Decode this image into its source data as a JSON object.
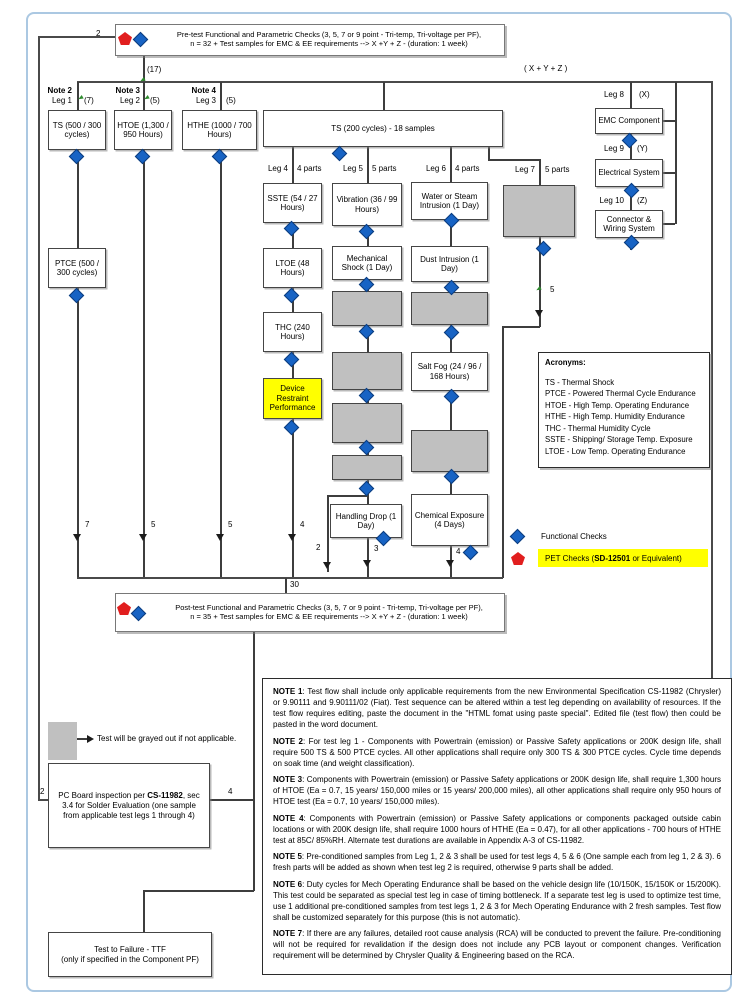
{
  "pretest": {
    "line1": "Pre-test Functional and Parametric Checks (3, 5, 7 or 9 point - Tri-temp, Tri-voltage per PF),",
    "line2": "n = 32 + Test samples for EMC & EE requirements --> X +Y + Z  - (duration: 1 week)"
  },
  "posttest": {
    "line1": "Post-test Functional and Parametric Checks (3, 5, 7 or 9 point - Tri-temp, Tri-voltage per PF),",
    "line2": "n = 35 + Test samples for EMC & EE requirements --> X +Y + Z  - (duration: 1 week)"
  },
  "labels": {
    "two": "2",
    "seventeen": "(17)",
    "xyz": "( X + Y + Z )",
    "thirty": "30",
    "leg1_count": "7",
    "leg2_count": "5",
    "leg3_count": "5",
    "leg4_count": "4",
    "leg5_branch": "2",
    "leg5_count": "3",
    "leg6_count": "4",
    "leg7_count": "5",
    "pc_left": "2",
    "pc_right": "4"
  },
  "top_legs": [
    {
      "note": "Note 2",
      "leg": "Leg 1",
      "count": "(7)",
      "box": "TS (500 / 300 cycles)"
    },
    {
      "note": "Note 3",
      "leg": "Leg 2",
      "count": "(5)",
      "box": "HTOE (1,300 / 950 Hours)"
    },
    {
      "note": "Note 4",
      "leg": "Leg 3",
      "count": "(5)",
      "box": "HTHE (1000 / 700 Hours)"
    }
  ],
  "mid_legs": [
    {
      "leg": "Leg 4",
      "parts": "4 parts"
    },
    {
      "leg": "Leg 5",
      "parts": "5 parts"
    },
    {
      "leg": "Leg 6",
      "parts": "4 parts"
    },
    {
      "leg": "Leg 7",
      "parts": "5 parts"
    }
  ],
  "right_legs": [
    {
      "leg": "Leg 8",
      "var": "(X)",
      "box": "EMC Component"
    },
    {
      "leg": "Leg 9",
      "var": "(Y)",
      "box": "Electrical System"
    },
    {
      "leg": "Leg 10",
      "var": "(Z)",
      "box": "Connector & Wiring System"
    }
  ],
  "boxes": {
    "ptce": "PTCE (500 / 300 cycles)",
    "ts200": "TS (200 cycles) - 18 samples",
    "sste": "SSTE (54 / 27 Hours)",
    "ltoe": "LTOE (48 Hours)",
    "thc": "THC (240 Hours)",
    "device": "Device Restraint Performance",
    "vibration": "Vibration (36 / 99 Hours)",
    "mshock": "Mechanical Shock (1 Day)",
    "hdrop": "Handling Drop (1 Day)",
    "water": "Water or Steam Intrusion (1 Day)",
    "dust": "Dust Intrusion (1 Day)",
    "saltfog": "Salt Fog (24 / 96 / 168 Hours)",
    "chem": "Chemical Exposure (4 Days)"
  },
  "acronyms": {
    "title": "Acronyms:",
    "items": [
      "TS - Thermal Shock",
      "PTCE - Powered Thermal Cycle Endurance",
      "HTOE - High Temp. Operating Endurance",
      "HTHE - High Temp. Humidity Endurance",
      "THC - Thermal Humidity Cycle",
      "SSTE - Shipping/ Storage Temp. Exposure",
      "LTOE - Low Temp. Operating Endurance"
    ]
  },
  "legend": {
    "functional": "Functional Checks",
    "pet_prefix": "PET Checks (",
    "pet_bold": "SD-12501",
    "pet_suffix": " or Equivalent)"
  },
  "gray_note": "Test will be grayed out if not applicable.",
  "pc_board": {
    "prefix": "PC Board inspection per ",
    "bold": "CS-11982",
    "suffix": ", sec 3.4 for Solder Evaluation (one sample from applicable test legs 1 through 4)"
  },
  "ttf": {
    "line1": "Test to Failure - TTF",
    "line2": "(only if specified in the Component PF)"
  },
  "colors": {
    "functional_check": "#1763c4",
    "pet_check": "#e11e1e",
    "grayed_test": "#c0c0c0",
    "highlight": "#ffff00",
    "page_border": "#abc8e2"
  },
  "notes": [
    {
      "label": "NOTE 1",
      "text": ": Test flow shall include only applicable requirements from the new Environmental Specification CS-11982 (Chrysler) or 9.90111 and 9.90111/02 (Fiat). Test sequence can be altered within a test leg depending on availability of resources.  If the test flow requires editing, paste the document in the \"HTML fomat using paste special\".  Edited file (test flow) then could be pasted in the word document."
    },
    {
      "label": "NOTE 2",
      "text": ": For test leg 1 - Components with Powertrain (emission) or Passive Safety applications or 200K design life, shall require 500 TS & 500 PTCE cycles. All other applications shall require only 300 TS & 300 PTCE cycles. Cycle time depends on soak time (and weight classification)."
    },
    {
      "label": "NOTE 3",
      "text": ": Components with Powertrain (emission) or Passive Safety applications or 200K design life, shall require 1,300 hours of HTOE (Ea = 0.7, 15 years/ 150,000 miles or 15 years/ 200,000 miles), all other applications shall require only 950 hours of HTOE test (Ea = 0.7, 10 years/ 150,000 miles)."
    },
    {
      "label": "NOTE 4",
      "text": ": Components with Powertrain (emission) or Passive Safety applications or components packaged outside cabin locations or with 200K design life, shall require 1000 hours of HTHE (Ea = 0.47), for all other applications - 700 hours of HTHE test at 85C/ 85%RH.  Alternate test durations are available in Appendix A-3 of CS-11982."
    },
    {
      "label": "NOTE 5",
      "text": ": Pre-conditioned samples from Leg 1, 2 & 3 shall be used for test legs 4, 5 & 6 (One sample each from leg 1, 2 & 3).  6 fresh parts will be added as shown when test leg 2 is required, otherwise 9 parts shall be added."
    },
    {
      "label": "NOTE 6",
      "text": ": Duty cycles for Mech Operating Endurance shall be based on the vehicle design life (10/150K, 15/150K or 15/200K).  This test could be separated as special test leg in case of timing bottleneck.  If a separate test leg is used to optimize test time, use 1 additional pre-conditioned samples from test legs 1, 2 & 3 for Mech Operating Endurance with 2 fresh samples.  Test flow shall be customized separately for this purpose (this is not automatic)."
    },
    {
      "label": "NOTE 7",
      "text": ": If there are any failures, detailed root cause analysis (RCA) will be conducted to prevent the failure. Pre-conditioning will not be required for revalidation if the design does not include any PCB layout or component changes. Verification requirement will be determined by Chrysler Quality & Engineering based on the RCA."
    }
  ]
}
